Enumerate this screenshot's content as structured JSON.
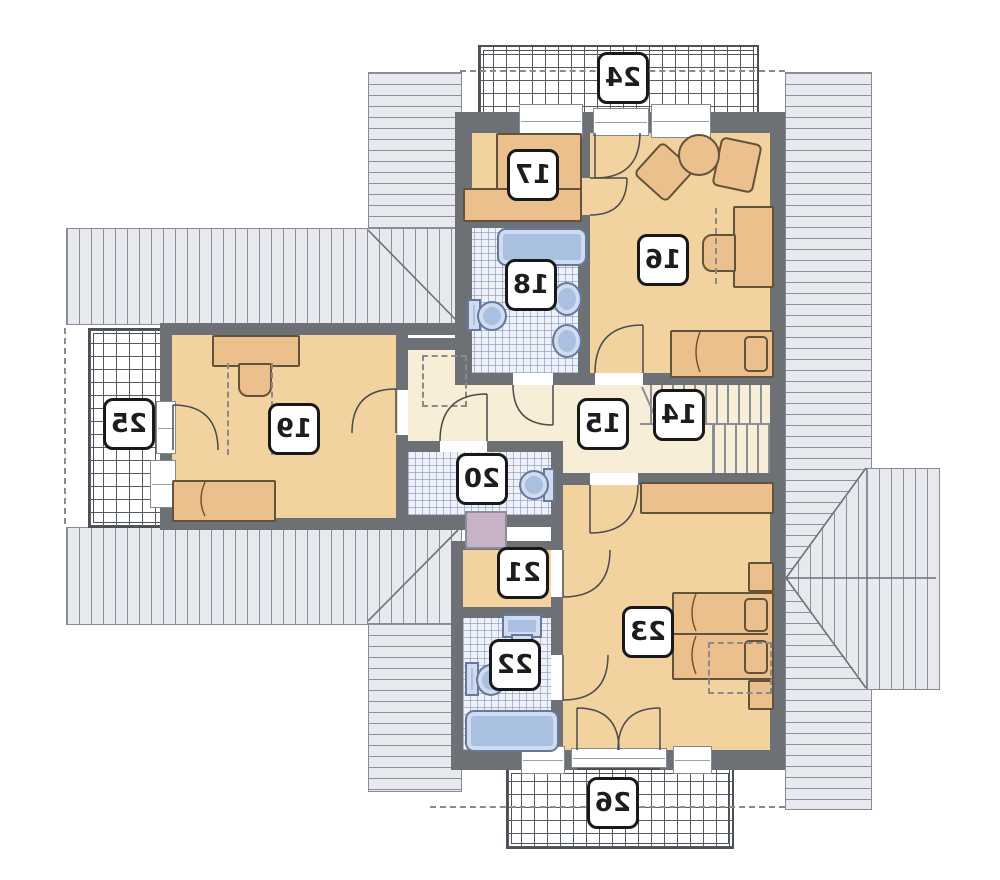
{
  "plan": {
    "rooms": [
      {
        "label": "14"
      },
      {
        "label": "15"
      },
      {
        "label": "16"
      },
      {
        "label": "17"
      },
      {
        "label": "18"
      },
      {
        "label": "19"
      },
      {
        "label": "20"
      },
      {
        "label": "21"
      },
      {
        "label": "22"
      },
      {
        "label": "23"
      },
      {
        "label": "24"
      },
      {
        "label": "25"
      },
      {
        "label": "26"
      }
    ],
    "colors": {
      "wall": "#6d7176",
      "room_floor": "#f2d3a0",
      "hall_floor": "#f8edd6",
      "tile_floor": "#eef1f7",
      "tile_line": "#7382af",
      "roof": "#e7e9ee",
      "roof_line": "#8a8f98",
      "fixture": "#a9c0e0",
      "fixture_line": "#63799f",
      "furniture": "#ecc08d",
      "furniture_line": "#63523c",
      "utility_box": "#c7b2c7",
      "label_border": "#191919"
    }
  }
}
